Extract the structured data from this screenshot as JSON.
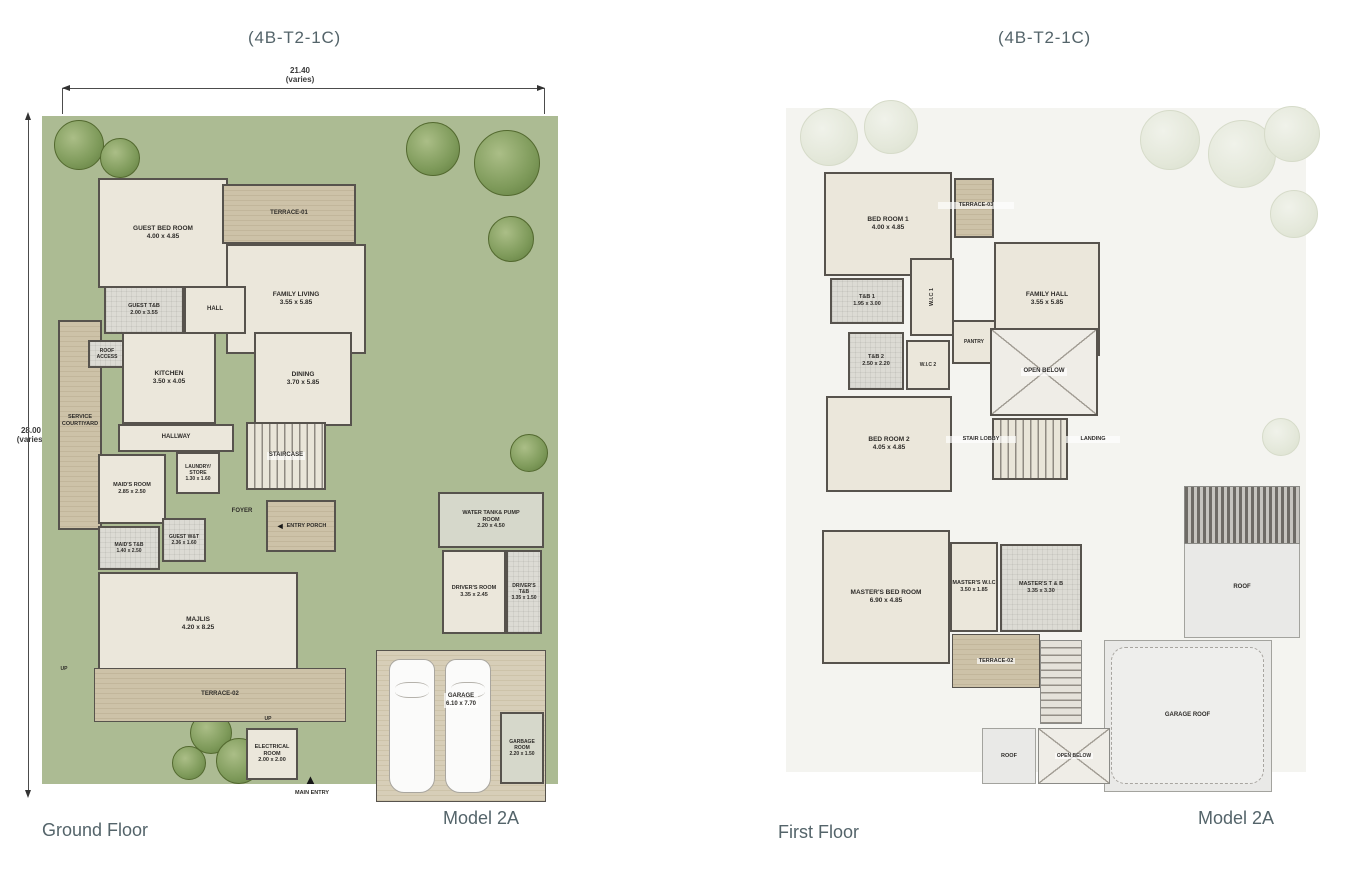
{
  "page": {
    "title_left": "(4B-T2-1C)",
    "title_right": "(4B-T2-1C)",
    "floor_left": "Ground Floor",
    "floor_right": "First Floor",
    "model_left": "Model 2A",
    "model_right": "Model 2A"
  },
  "dims": {
    "top_value": "21.40",
    "top_note": "(varies)",
    "side_value": "28.00",
    "side_note": "(varies)"
  },
  "icons": {
    "entry_porch_arrow": "◄",
    "main_entry_arrow": "▲"
  },
  "colors": {
    "lawn": "#acbb93",
    "wall": "#57534d",
    "room": "#ebe7db",
    "faded": "#f4f4f0",
    "title_text": "#54646a",
    "label_text": "#2e2c29",
    "dim_text": "#3a3a3a"
  },
  "ground": {
    "rooms": {
      "guest_bed": {
        "name": "GUEST BED ROOM",
        "dims": "4.00 x 4.85"
      },
      "terrace01": {
        "name": "TERRACE-01"
      },
      "family_living": {
        "name": "FAMILY LIVING",
        "dims": "3.55 x 5.85"
      },
      "guest_tb": {
        "name": "GUEST T&B",
        "dims": "2.00 x 3.55"
      },
      "hall": {
        "name": "HALL"
      },
      "roof_access": {
        "name": "ROOF ACCESS"
      },
      "kitchen": {
        "name": "KITCHEN",
        "dims": "3.50 x 4.05"
      },
      "dining": {
        "name": "DINING",
        "dims": "3.70 x 5.85"
      },
      "service_courtyard": {
        "name": "SERVICE COURTIYARD"
      },
      "hallway": {
        "name": "HALLWAY"
      },
      "laundry_store": {
        "name": "LAUNDRY/ STORE",
        "dims": "1.30 x 1.60"
      },
      "maids_room": {
        "name": "MAID'S ROOM",
        "dims": "2.85 x 2.50"
      },
      "staircase": {
        "name": "STAIRCASE"
      },
      "maids_tb": {
        "name": "MAID'S T&B",
        "dims": "1.40 x 2.50"
      },
      "guest_wt": {
        "name": "GUEST W&T",
        "dims": "2.36 x 1.60"
      },
      "foyer": {
        "name": "FOYER"
      },
      "entry_porch": {
        "name": "ENTRY PORCH"
      },
      "majlis": {
        "name": "MAJLIS",
        "dims": "4.20 x 8.25"
      },
      "water_tank": {
        "name": "WATER TANK& PUMP ROOM",
        "dims": "2.20 x 4.50"
      },
      "drivers_room": {
        "name": "DRIVER'S ROOM",
        "dims": "3.35 x 2.45"
      },
      "drivers_tb": {
        "name": "DRIVER'S T&B",
        "dims": "3.35 x 1.50"
      },
      "terrace02": {
        "name": "TERRACE-02"
      },
      "garage": {
        "name": "GARAGE",
        "dims": "6.10 x 7.70"
      },
      "electrical": {
        "name": "ELECTRICAL ROOM",
        "dims": "2.00 x 2.00"
      },
      "garbage": {
        "name": "GARBAGE ROOM",
        "dims": "2.20 x 1.50"
      },
      "main_entry": {
        "name": "MAIN ENTRY"
      },
      "up": {
        "name": "UP"
      }
    }
  },
  "first": {
    "rooms": {
      "bed1": {
        "name": "BED ROOM 1",
        "dims": "4.00 x 4.85"
      },
      "terrace03": {
        "name": "TERRACE-03"
      },
      "family_hall": {
        "name": "FAMILY HALL",
        "dims": "3.55 x 5.85"
      },
      "tb1": {
        "name": "T&B 1",
        "dims": "1.95 x 3.00"
      },
      "wic1": {
        "name": "W.I.C 1"
      },
      "tb2": {
        "name": "T&B 2",
        "dims": "2.50 x 2.20"
      },
      "wic2": {
        "name": "W.I.C 2"
      },
      "pantry": {
        "name": "PANTRY"
      },
      "open_below": {
        "name": "OPEN BELOW"
      },
      "bed2": {
        "name": "BED ROOM 2",
        "dims": "4.05 x 4.85"
      },
      "stair_lobby": {
        "name": "STAIR LOBBY"
      },
      "landing": {
        "name": "LANDING"
      },
      "master_bed": {
        "name": "MASTER'S BED ROOM",
        "dims": "6.90 x 4.85"
      },
      "master_wic": {
        "name": "MASTER'S W.I.C",
        "dims": "3.50 x 1.85"
      },
      "master_tb": {
        "name": "MASTER'S T & B",
        "dims": "3.35 x 3.30"
      },
      "terrace02": {
        "name": "TERRACE-02"
      },
      "roof_right": {
        "name": "ROOF"
      },
      "garage_roof": {
        "name": "GARAGE ROOF"
      },
      "roof_small": {
        "name": "ROOF"
      },
      "open_below2": {
        "name": "OPEN BELOW"
      }
    }
  }
}
